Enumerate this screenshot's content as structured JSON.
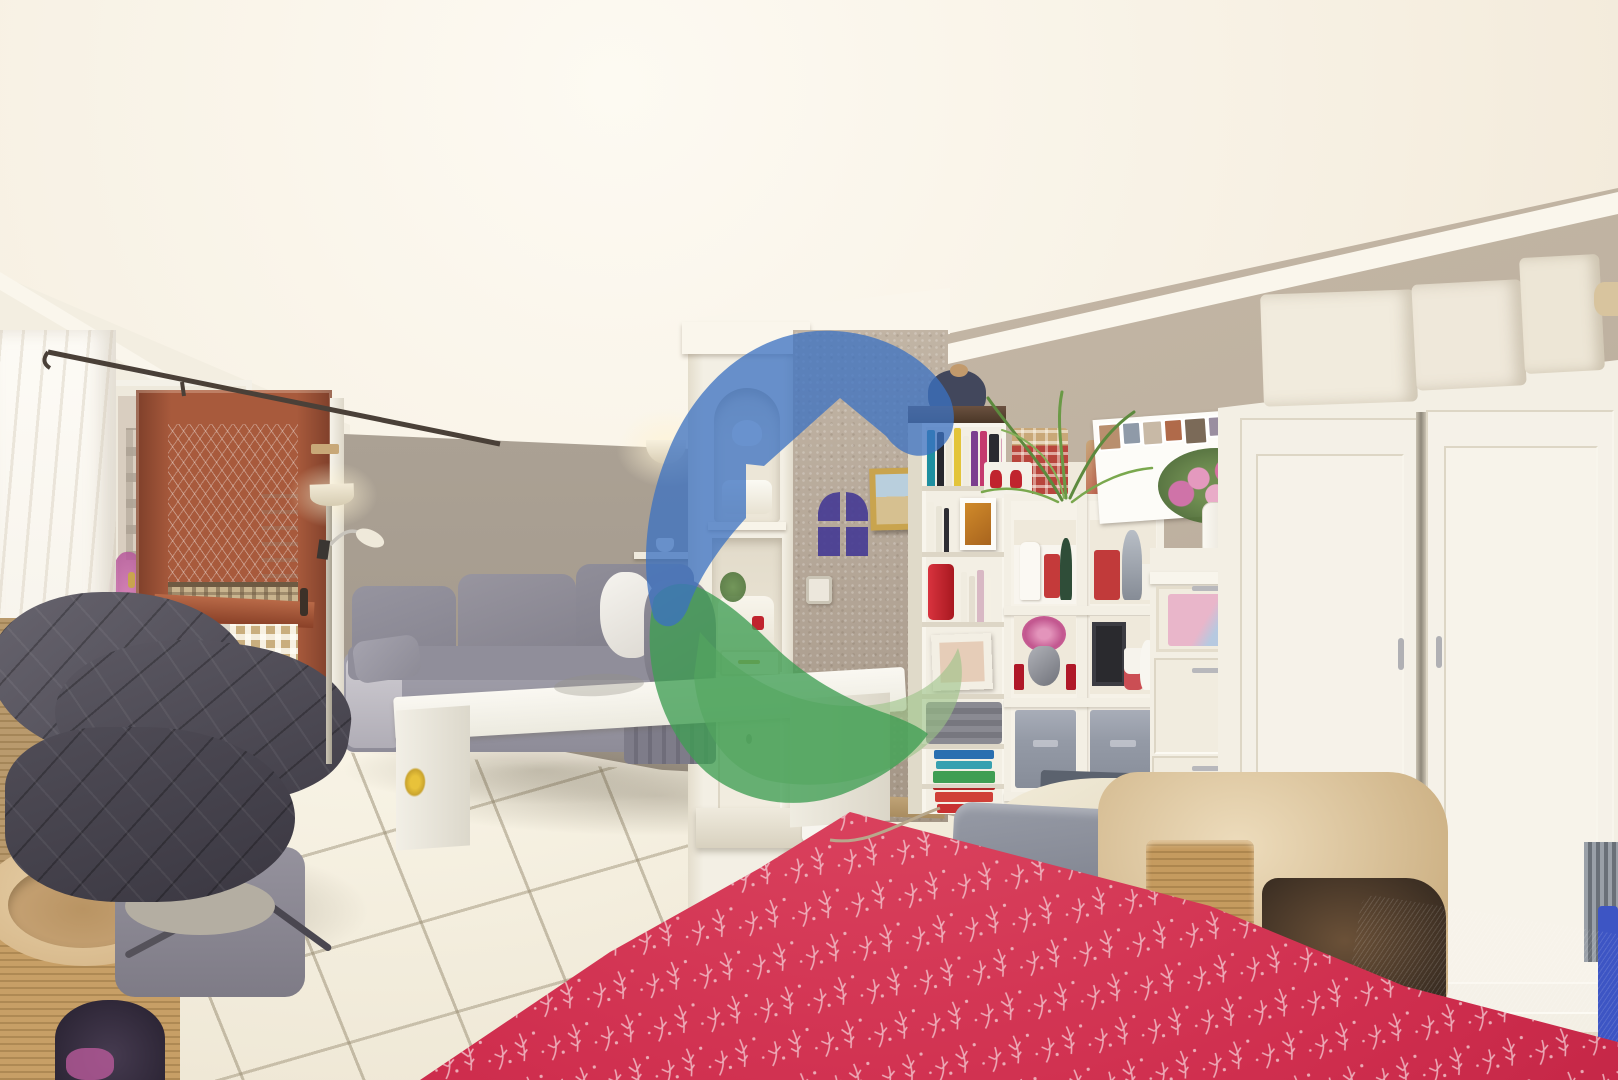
{
  "meta": {
    "type": "real-estate interior photograph",
    "description": "Wide-angle photo of a bright living room: balcony door and window on the left with a grey quilted armchair and cat tree, grey corner sofa with white coffee table, central white built-in column with display niches, taupe stucco pillar, tall white bookshelf and cube shelving full of Christmas ornaments, white chest of drawers with pink flowers, large white wardrobe with woven boxes on top, and a red patterned tablecloth in the foreground. A blue/green house-logo watermark is overlaid in the centre.",
    "watermark": "circular house-in-circle agency logo, semi-transparent"
  },
  "palette": {
    "ceiling": "#f8f3e8",
    "ceilingBright": "#fdfaf2",
    "wallFarLeft": "#a79d90",
    "wallStucco": "#b2a495",
    "wallRight": "#bfb2a1",
    "cornice": "#faf6ec",
    "furnWhite": "#f3efe4",
    "terracotta": "#a85a3c",
    "terracottaDark": "#7e3f2a",
    "sofaGrey": "#8b8894",
    "sofaDark": "#7a7884",
    "floorTile": "#efe8d8",
    "grout": "#b9ac94",
    "blanketGrey": "#4e4b55",
    "catTan": "#c79f66",
    "catPlush": "#dcc096",
    "tableclothRed": "#d23c57",
    "sprigWhite": "#f2c9cf",
    "logoBlue": "#3b71c1",
    "logoGreen": "#3f9e53",
    "logoGreenLight": "#9dc489",
    "logoWindowPurple": "#463c94",
    "goldFrame": "#c9a44e",
    "awningOrange": "#cf7a4e",
    "awningCream": "#e8dcc8",
    "lawnGreen": "#7ba052",
    "balconyMaroon": "#7b3a33",
    "buildingBeige": "#d5cabb",
    "flowerPink": "#d66a9e",
    "redDecor": "#c0242e",
    "tinselSilver": "#9aa0a8",
    "binGrey": "#949aa6",
    "trayDark": "#3f3f42",
    "bearDark": "#3a3f52",
    "pinkToy": "#d84b7e",
    "magentaOutside": "#c95fa0",
    "blueFrame": "#2255b8",
    "chairGrey": "#878b96",
    "fleeceCream": "#ece4cf",
    "glassBlue": "#a8c0dc",
    "glassPink": "#e8a8c0"
  },
  "scene": {
    "labels": {
      "photo": "living room listing photo",
      "watermark": "agency house logo watermark",
      "curtain": "white sheer curtain",
      "window": "window with view of apartment buildings",
      "door": "open terracotta-framed balcony door",
      "armchair": "grey recliner with quilted blanket",
      "catTree": "beige cat tree with plush bed",
      "sofa": "grey corner sofa",
      "coffeeTable": "white coffee table",
      "floorLamp": "torchiere floor lamp with reading arm",
      "sconce": "half-bowl wall sconce",
      "column": "white built-in display column",
      "stucco": "taupe stucco pillar with stencilled window",
      "painting": "gold-framed beach painting",
      "bookshelf": "tall white bookshelf",
      "cubeShelf": "white cube shelf with Christmas ornaments",
      "collage": "white multi-photo collage frame",
      "dresser": "white chest of drawers with frosted drawer",
      "vase": "white vase with pink peonies",
      "wardrobe": "large white two-door wardrobe",
      "boxes": "woven storage boxes on wardrobe",
      "tablecloth": "red tablecloth with white sprig pattern",
      "chairs": "grey dining chairs",
      "catBed": "beige plush cat bed and sisal scratcher"
    },
    "bookshelf": {
      "rows": {
        "r1": [
          [
            "#1f8fa0",
            8,
            56
          ],
          [
            "#26262c",
            7,
            54
          ],
          [
            "#ece6d6",
            6,
            48
          ],
          [
            "#e3c43a",
            7,
            58
          ],
          [
            "#f0ece0",
            6,
            50
          ],
          [
            "#7c3e8f",
            7,
            55
          ],
          [
            "#c43a6e",
            7,
            55
          ],
          [
            "#2b2b31",
            10,
            52
          ],
          [
            "#d8a0b8",
            6,
            48
          ]
        ],
        "r2": [
          [
            "#f2eee2",
            7,
            50
          ],
          [
            "#e8e4d6",
            6,
            46
          ],
          [
            "#2e2e34",
            5,
            44
          ]
        ],
        "r3": [
          [
            "#f0ece0",
            6,
            50
          ],
          [
            "#e4ded0",
            6,
            46
          ],
          [
            "#d8b8c4",
            7,
            52
          ],
          [
            "#f4f0e4",
            5,
            44
          ]
        ],
        "r6": [
          [
            "#2a6fb0",
            60,
            9
          ],
          [
            "#37a0b0",
            56,
            8
          ],
          [
            "#3f9e53",
            62,
            12
          ]
        ],
        "r7": [
          [
            "#b02828",
            62,
            10
          ],
          [
            "#d04038",
            58,
            10
          ],
          [
            "#c83030",
            54,
            9
          ]
        ]
      }
    },
    "collage": {
      "photos": [
        [
          "#b98f6e",
          20,
          24
        ],
        [
          "#8f9aa8",
          16,
          20
        ],
        [
          "#c8b9a6",
          18,
          22
        ],
        [
          "#b06a4a",
          16,
          20
        ],
        [
          "#7b6a58",
          20,
          24
        ],
        [
          "#9a8ea0",
          14,
          18
        ]
      ]
    }
  }
}
